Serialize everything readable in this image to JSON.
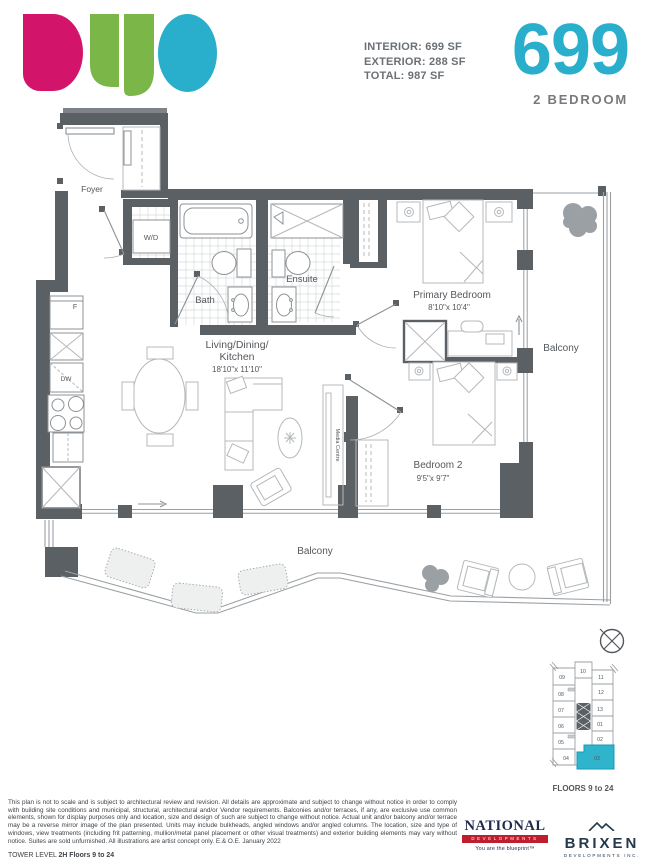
{
  "header": {
    "logo_word": "DUO",
    "brand_colors": {
      "magenta": "#d2146b",
      "green": "#7ab648",
      "teal": "#29aecb",
      "gray_bar": "#7f8387"
    },
    "stats": {
      "interior": "INTERIOR: 699 SF",
      "exterior": "EXTERIOR: 288 SF",
      "total": "TOTAL: 987 SF"
    },
    "unit_number": "699",
    "unit_type": "2 BEDROOM"
  },
  "plan": {
    "labels": {
      "foyer": "Foyer",
      "wd": "W/D",
      "bath": "Bath",
      "ensuite": "Ensuite",
      "living_line1": "Living/Dining/",
      "living_line2": "Kitchen",
      "living_dims": "18'10\"x 11'10\"",
      "primary": "Primary Bedroom",
      "primary_dims": "8'10\"x 10'4\"",
      "bedroom2": "Bedroom 2",
      "bedroom2_dims": "9'5\"x 9'7\"",
      "balcony_right": "Balcony",
      "balcony_bottom": "Balcony",
      "media": "Media Centre",
      "fridge": "F",
      "dishwasher": "DW"
    }
  },
  "keyplan": {
    "floors_label": "FLOORS 9 to 24",
    "highlighted_unit": "03",
    "highlight_color": "#2fb4cc",
    "units": [
      {
        "label": "09"
      },
      {
        "label": "10"
      },
      {
        "label": "11"
      },
      {
        "label": "08"
      },
      {
        "label": "12"
      },
      {
        "label": "07"
      },
      {
        "label": "13"
      },
      {
        "label": "06"
      },
      {
        "label": "01"
      },
      {
        "label": "05"
      },
      {
        "label": "02"
      },
      {
        "label": "04"
      },
      {
        "label": "03"
      }
    ]
  },
  "footer": {
    "disclaimer": "This plan is not to scale and is subject to architectural review and revision. All details are approximate and subject to change without notice in order to comply with building site conditions and municipal, structural, architectural and/or Vendor requirements. Balconies and/or terraces, if any, are exclusive use common elements, shown for display purposes only and location, size and design of such are subject to change without notice. Actual unit and/or balcony and/or terrace may be a reverse mirror image of the plan presented. Units may include bulkheads, angled windows and/or angled columns. The location, size and type of windows, view treatments (including frit patterning, mullion/metal panel placement or other visual treatments) and exterior building elements may vary without notice. Suites are sold unfurnished. All illustrations are artist concept only. E.& O.E. January 2022",
    "tower_level_prefix": "TOWER LEVEL ",
    "tower_level_value": "2H Floors 9 to 24",
    "national": {
      "name": "NATIONAL",
      "division": "DEVELOPMENTS",
      "tagline": "You are the blueprint™"
    },
    "brixen": {
      "name": "BRIXEN",
      "division": "DEVELOPMENTS INC."
    }
  },
  "icons": {
    "compass": "crossed-circle",
    "mountain": "two-peaks",
    "entry_arrow": "right-arrow",
    "window_arrow": "up-arrow"
  }
}
